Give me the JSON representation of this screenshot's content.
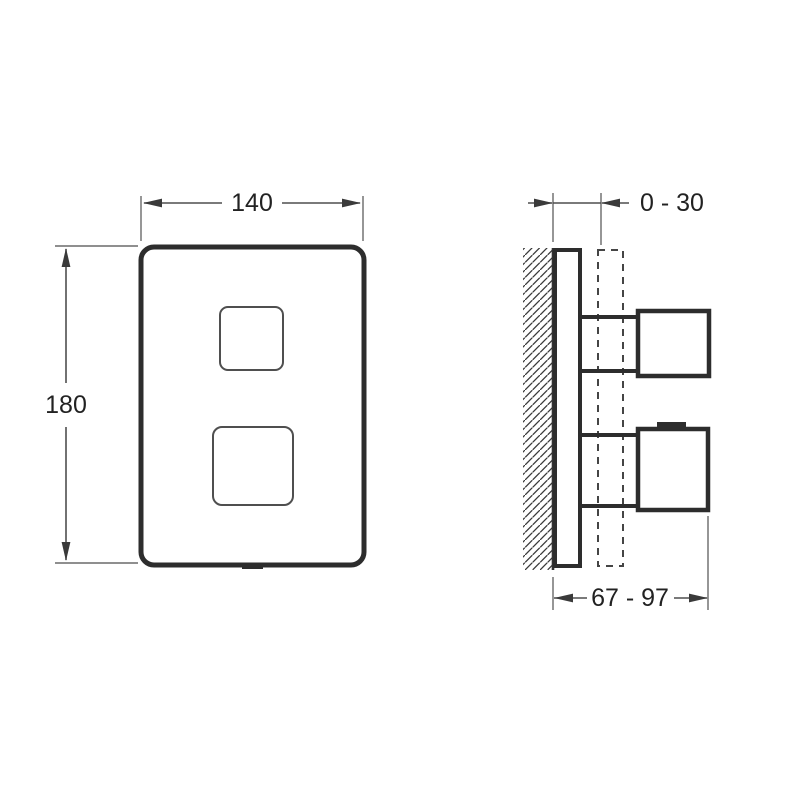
{
  "labels": {
    "front_width": "140",
    "front_height": "180",
    "wall_offset": "0 - 30",
    "handle_depth": "67 - 97"
  },
  "colors": {
    "line_dark": "#2d2d2d",
    "line_thin": "#4f4f4f",
    "dimension_text": "#222222",
    "background": "#ffffff"
  }
}
